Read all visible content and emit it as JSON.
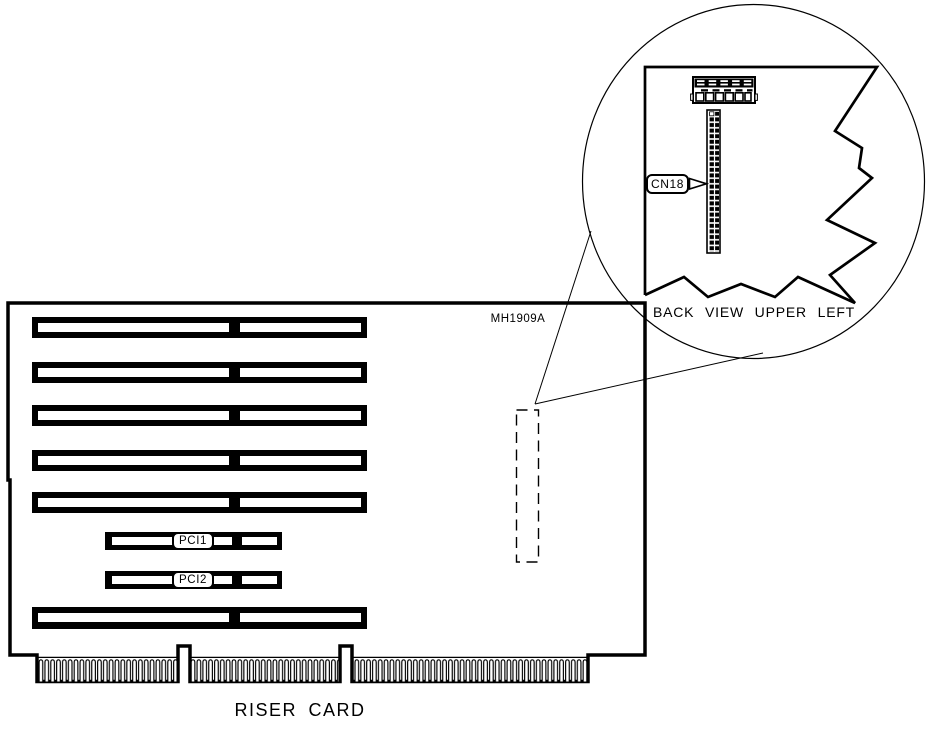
{
  "diagram": {
    "board": {
      "part_number": "MH1909A",
      "caption": "RISER CARD",
      "slots": {
        "pci1_label": "PCI1",
        "pci2_label": "PCI2"
      },
      "isa_slot_count": 6,
      "edge_connector_segments": 3
    },
    "detail_view": {
      "caption": "BACK VIEW UPPER LEFT",
      "connector_label": "CN18"
    },
    "colors": {
      "ink": "#000000",
      "paper": "#ffffff"
    }
  }
}
